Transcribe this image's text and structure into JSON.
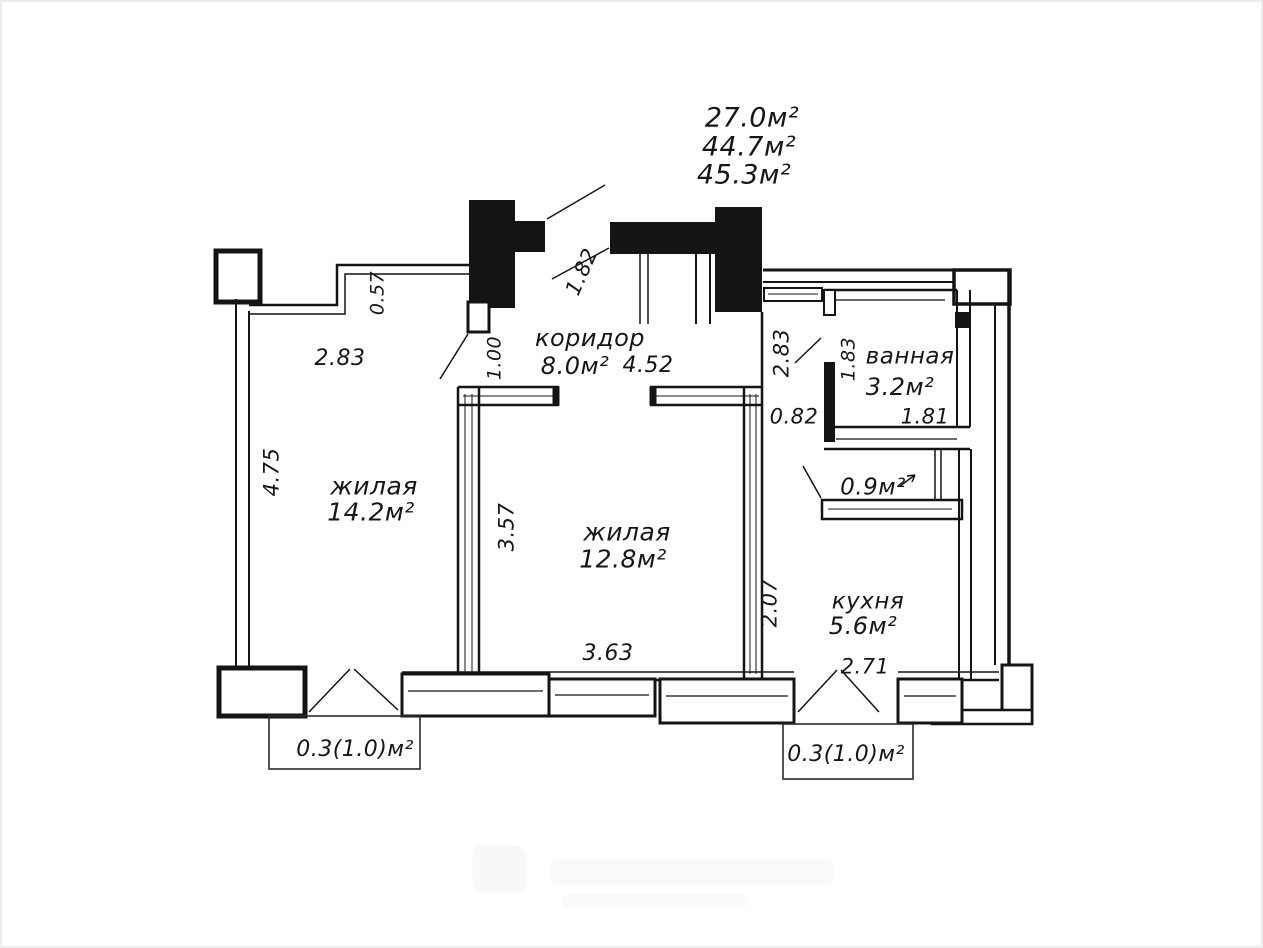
{
  "title_areas": {
    "line1": "27.0м²",
    "line2": "44.7м²",
    "line3": "45.3м²"
  },
  "rooms": {
    "living1": {
      "label": "жилая",
      "area": "14.2м²"
    },
    "living2": {
      "label": "жилая",
      "area": "12.8м²"
    },
    "corridor": {
      "label": "коридор",
      "area": "8.0м²"
    },
    "bathroom": {
      "label": "ванная",
      "area": "3.2м²"
    },
    "kitchen": {
      "label": "кухня",
      "area": "5.6м²"
    },
    "storage": {
      "area": "0.9м²"
    }
  },
  "balconies": {
    "left": {
      "area": "0.3(1.0)м²"
    },
    "right": {
      "area": "0.3(1.0)м²"
    }
  },
  "dimensions": {
    "d283_left": "2.83",
    "d057": "0.57",
    "d475": "4.75",
    "d100": "1.00",
    "d182": "1.82",
    "d452": "4.52",
    "d283_right": "2.83",
    "d183": "1.83",
    "d082": "0.82",
    "d181": "1.81",
    "d357": "3.57",
    "d363": "3.63",
    "d207": "2.07",
    "d271": "2.71"
  },
  "colors": {
    "ink": "#161616",
    "wall_fill": "#141414",
    "background": "#ffffff"
  }
}
